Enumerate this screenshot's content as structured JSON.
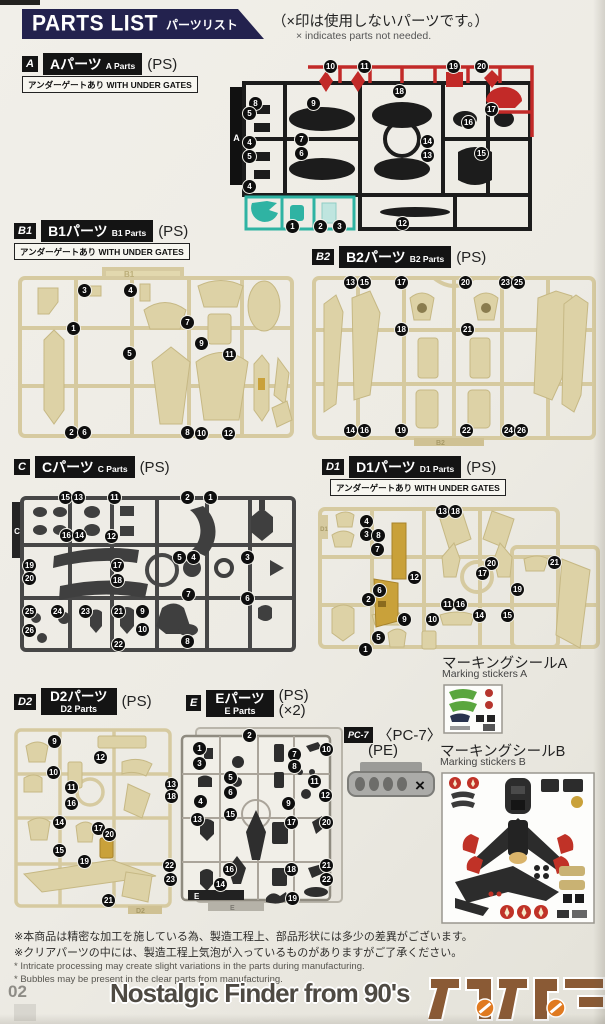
{
  "header": {
    "title_en": "PARTS LIST",
    "title_jp": "パーツリスト",
    "note_jp": "（×印は使用しないパーツです。）",
    "note_en": "× indicates parts not needed."
  },
  "sections": {
    "a": {
      "badge": "A",
      "name_jp": "Aパーツ",
      "name_en": "A Parts",
      "material": "(PS)",
      "note": "アンダーゲートあり WITH UNDER GATES",
      "part_numbers": [
        "8",
        "5",
        "4",
        "5",
        "4",
        "9",
        "7",
        "6",
        "10",
        "11",
        "18",
        "19",
        "20",
        "17",
        "16",
        "14",
        "13",
        "15",
        "1",
        "2",
        "3",
        "12"
      ]
    },
    "b1": {
      "badge": "B1",
      "name_jp": "B1パーツ",
      "name_en": "B1 Parts",
      "material": "(PS)",
      "note": "アンダーゲートあり WITH UNDER GATES",
      "part_numbers": [
        "3",
        "4",
        "1",
        "7",
        "9",
        "11",
        "5",
        "2",
        "6",
        "8",
        "10",
        "12"
      ]
    },
    "b2": {
      "badge": "B2",
      "name_jp": "B2パーツ",
      "name_en": "B2 Parts",
      "material": "(PS)",
      "part_numbers": [
        "13",
        "15",
        "17",
        "20",
        "23",
        "25",
        "18",
        "21",
        "14",
        "16",
        "19",
        "22",
        "24",
        "26"
      ]
    },
    "c": {
      "badge": "C",
      "name_jp": "Cパーツ",
      "name_en": "C Parts",
      "material": "(PS)",
      "part_numbers": [
        "15",
        "13",
        "11",
        "2",
        "1",
        "16",
        "14",
        "12",
        "19",
        "17",
        "18",
        "5",
        "4",
        "3",
        "20",
        "7",
        "6",
        "25",
        "24",
        "23",
        "21",
        "9",
        "26",
        "10",
        "8",
        "22"
      ]
    },
    "d1": {
      "badge": "D1",
      "name_jp": "D1パーツ",
      "name_en": "D1 Parts",
      "material": "(PS)",
      "note": "アンダーゲートあり WITH UNDER GATES",
      "part_numbers": [
        "13",
        "18",
        "4",
        "3",
        "8",
        "7",
        "20",
        "21",
        "17",
        "12",
        "19",
        "6",
        "2",
        "11",
        "16",
        "14",
        "15",
        "9",
        "10",
        "5",
        "1"
      ]
    },
    "d2": {
      "badge": "D2",
      "name_jp": "D2パーツ",
      "name_en": "D2 Parts",
      "material": "(PS)",
      "part_numbers": [
        "9",
        "12",
        "10",
        "11",
        "13",
        "18",
        "16",
        "14",
        "17",
        "20",
        "15",
        "19",
        "22",
        "23",
        "21"
      ]
    },
    "e": {
      "badge": "E",
      "name_jp": "Eパーツ",
      "name_en": "E Parts",
      "material": "(PS)",
      "quantity": "(×2)",
      "part_numbers": [
        "2",
        "1",
        "3",
        "10",
        "7",
        "8",
        "5",
        "11",
        "6",
        "4",
        "12",
        "9",
        "13",
        "15",
        "17",
        "20",
        "16",
        "18",
        "21",
        "22",
        "14",
        "19"
      ]
    },
    "pc7": {
      "badge": "PC-7",
      "name": "〈PC-7〉",
      "material": "(PE)",
      "unused_mark": "×"
    }
  },
  "stickers": {
    "a": {
      "title_jp": "マーキングシールA",
      "title_en": "Marking stickers A"
    },
    "b": {
      "title_jp": "マーキングシールB",
      "title_en": "Marking stickers B"
    }
  },
  "footnotes": {
    "jp1": "※本商品は精密な加工を施している為、製造工程上、部品形状には多少の差異がございます。",
    "jp2": "※クリアパーツの中には、製造工程上気泡が入っているものがありますがご了承ください。",
    "en1": "* Intricate processing may create slight variations in the parts during manufacturing.",
    "en2": "* Bubbles may be present in the clear parts from manufacturing."
  },
  "footer": {
    "page_number": "02",
    "watermark": "Nostalgic Finder from 90's"
  },
  "colors": {
    "banner_navy": "#23224e",
    "runner_black": "#1c1c1c",
    "runner_red": "#c22a28",
    "runner_teal": "#2fb3a3",
    "runner_beige": "#dcd1a4",
    "runner_dark_gray": "#474747",
    "runner_gold": "#c9a13a",
    "sticker_green": "#5aa63e",
    "sticker_red": "#c03227",
    "logo_brown": "#8a5a35"
  }
}
